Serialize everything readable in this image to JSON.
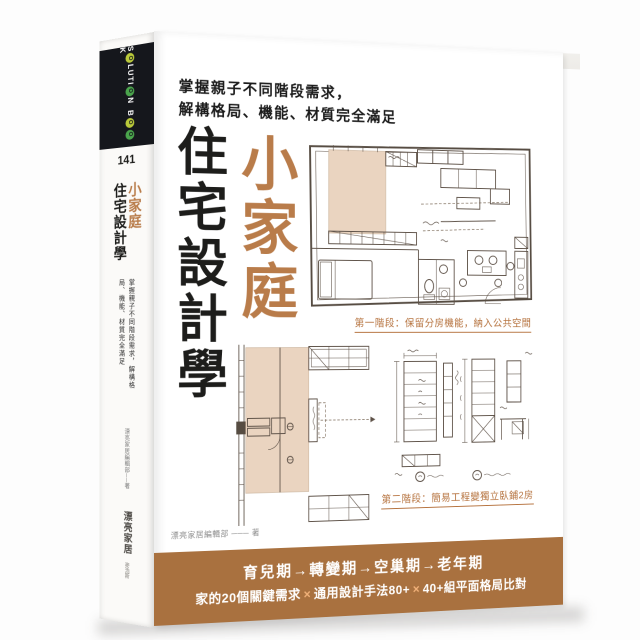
{
  "book": {
    "spine": {
      "logo": {
        "parts": [
          "S",
          "O",
          "LUTI",
          "O",
          "N",
          "B",
          "O",
          "O",
          "K"
        ]
      },
      "series_number": "141",
      "title_main": "小家庭",
      "title_rest": "住宅設計學",
      "tagline": "掌握親子不同階段需求，解構格局、機能、材質完全滿足",
      "author": "漂亮家居編輯部──著",
      "publisher": "漂亮家居",
      "publisher_sub": "麥浩斯"
    },
    "cover": {
      "tagline_line1": "掌握親子不同階段需求，",
      "tagline_line2": "解構格局、機能、材質完全滿足",
      "title_main": "小家庭",
      "title_rest": "住宅設計學",
      "plan1_caption": "第一階段：保留分房機能，納入公共空間",
      "plan2_caption": "第二階段：簡易工程變獨立臥鋪2房",
      "author_line": "漂亮家居編輯部 ─── 著",
      "banner": {
        "line1": "育兒期→轉變期→空巢期→老年期",
        "line2_part1": "家的20個關鍵需求",
        "line2_sep": "×",
        "line2_part2": "通用設計手法80+",
        "line2_part3": "40+組平面格局比對"
      }
    },
    "colors": {
      "accent_brown": "#b97c4a",
      "band_brown": "#a9713f",
      "caption_orange": "#b5713c",
      "plan_fill_beige": "#ead4c0",
      "logo_green": "#4aa44c",
      "logo_yellow_green": "#b9c93a",
      "spine_band_black": "#15171c"
    }
  }
}
